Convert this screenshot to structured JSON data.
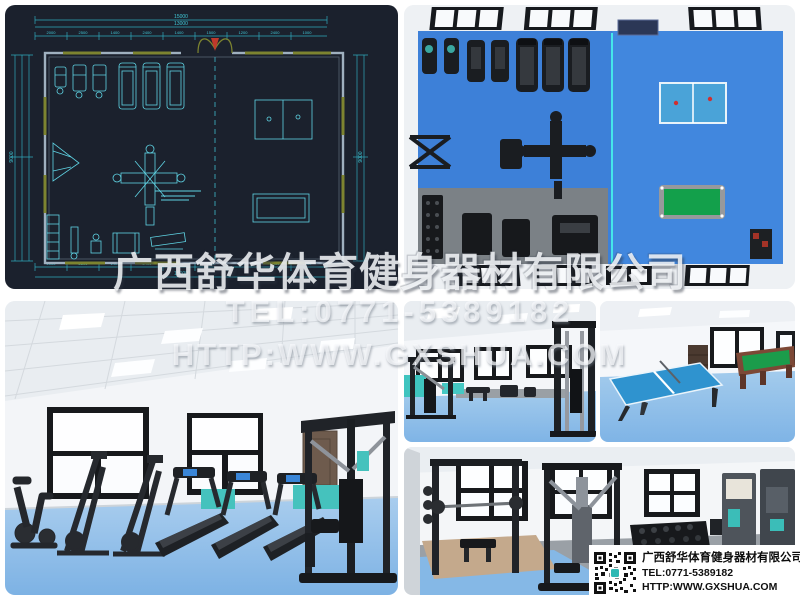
{
  "watermark": {
    "company": "广西舒华体育健身器材有限公司",
    "tel": "TEL:0771-5389182",
    "url": "HTTP:WWW.GXSHUA.COM"
  },
  "info_box": {
    "company": "广西舒华体育健身器材有限公司",
    "tel": "TEL:0771-5389182",
    "url": "HTTP:WWW.GXSHUA.COM"
  },
  "cad": {
    "dim_total_top": "15000",
    "dim_inner_top": "13000",
    "dim_total_bottom": "15000",
    "dim_left": "9000",
    "dim_right": "9000",
    "dim_segments_top": [
      "2000",
      "2500",
      "1400",
      "2400",
      "1400",
      "1500",
      "1200",
      "2400",
      "1000"
    ],
    "dim_segments_bottom": [
      "2000",
      "2500",
      "1400",
      "2400",
      "1400",
      "1500",
      "1200",
      "2400",
      "1000"
    ]
  },
  "colors": {
    "cad_background": "#1b212d",
    "cad_line_cyan": "#5fd4e4",
    "floor_blue_topview": "#3d80d8",
    "floor_blue_photo": "#8fc0e8",
    "teal_accent": "#3fc4bf",
    "tt_table_blue": "#2f93cf",
    "pool_table_green": "#169c48",
    "qr_logo_teal": "#2fb9b4"
  }
}
